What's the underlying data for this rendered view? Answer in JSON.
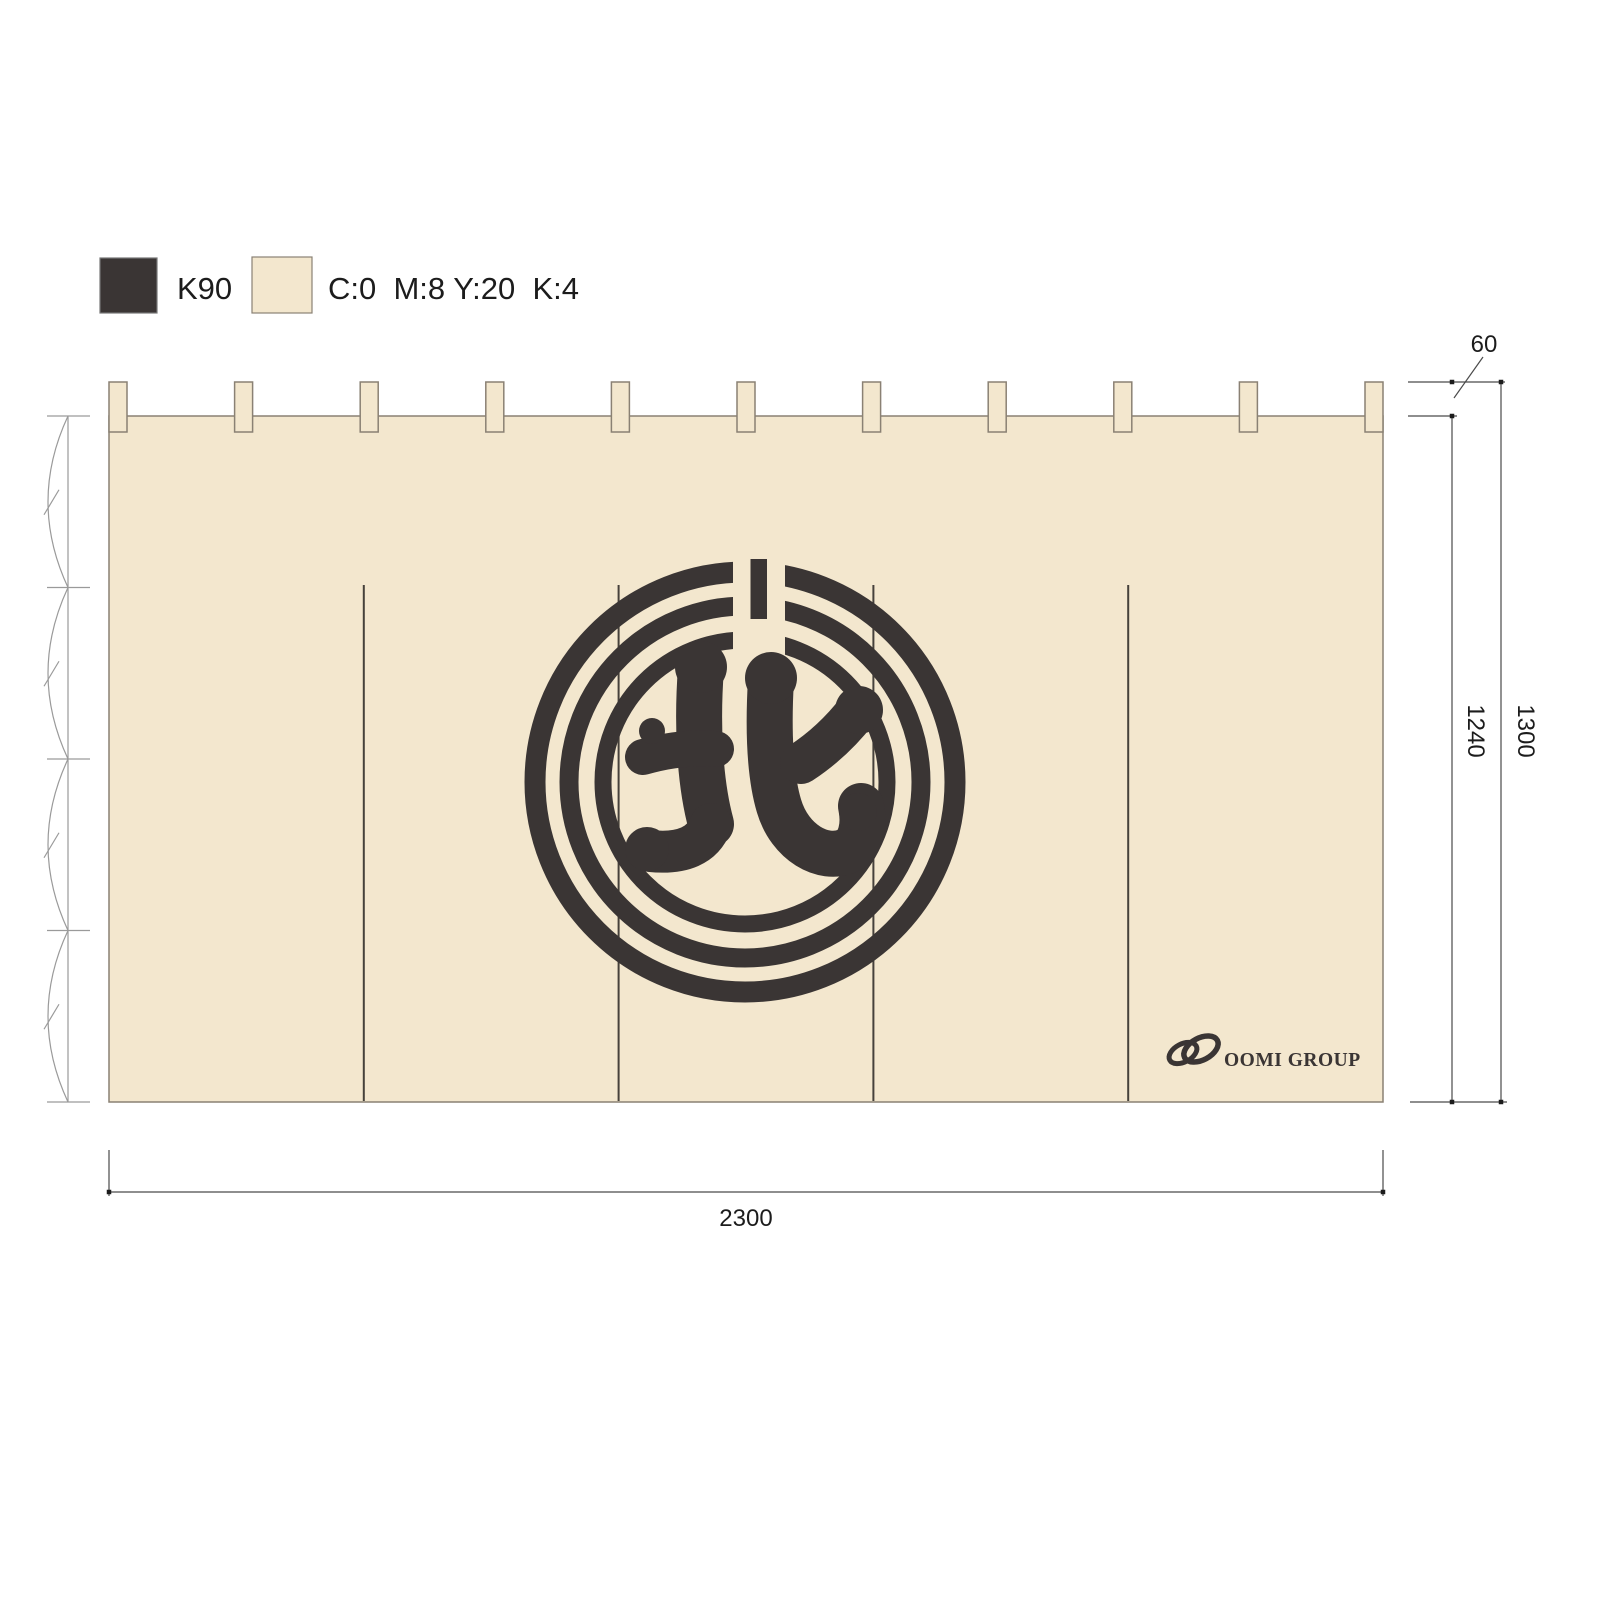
{
  "title": "Noren curtain production drawing",
  "legend": {
    "swatches": [
      {
        "name": "dark",
        "label": "K90",
        "hex": "#3a3534"
      },
      {
        "name": "cream",
        "label": "C:0  M:8 Y:20  K:4",
        "hex": "#f3e7ce"
      }
    ]
  },
  "curtain": {
    "kanji": "北",
    "brand": "OOMI GROUP",
    "panels": 5,
    "tabs": 11
  },
  "dimensions": {
    "tab_height": "60",
    "inner_height": "1240",
    "total_height": "1300",
    "width": "2300"
  },
  "colors": {
    "dark": "#3a3534",
    "cream": "#f3e7ce",
    "outline": "#8a8174",
    "dimension": "#4a4a4a",
    "annotation": "#9a9a9a"
  }
}
